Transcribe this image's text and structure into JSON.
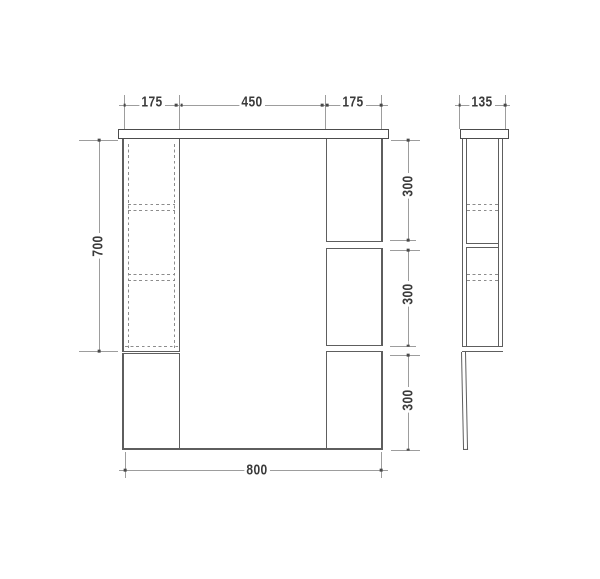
{
  "drawing": {
    "front_view": {
      "dim_top_left": "175",
      "dim_top_center": "450",
      "dim_top_right": "175",
      "dim_height_upper": "700",
      "dim_right_sections": [
        "300",
        "300",
        "300"
      ],
      "dim_width_total": "800"
    },
    "side_view": {
      "dim_depth": "135"
    }
  },
  "style": {
    "background": "#ffffff",
    "object_line_color": "#5e5e5e",
    "panel_line_color": "#4c4c4c",
    "dimension_line_color": "#9d9d9d",
    "hidden_line_color": "#8c8c8c",
    "label_color": "#3a3a3a"
  }
}
